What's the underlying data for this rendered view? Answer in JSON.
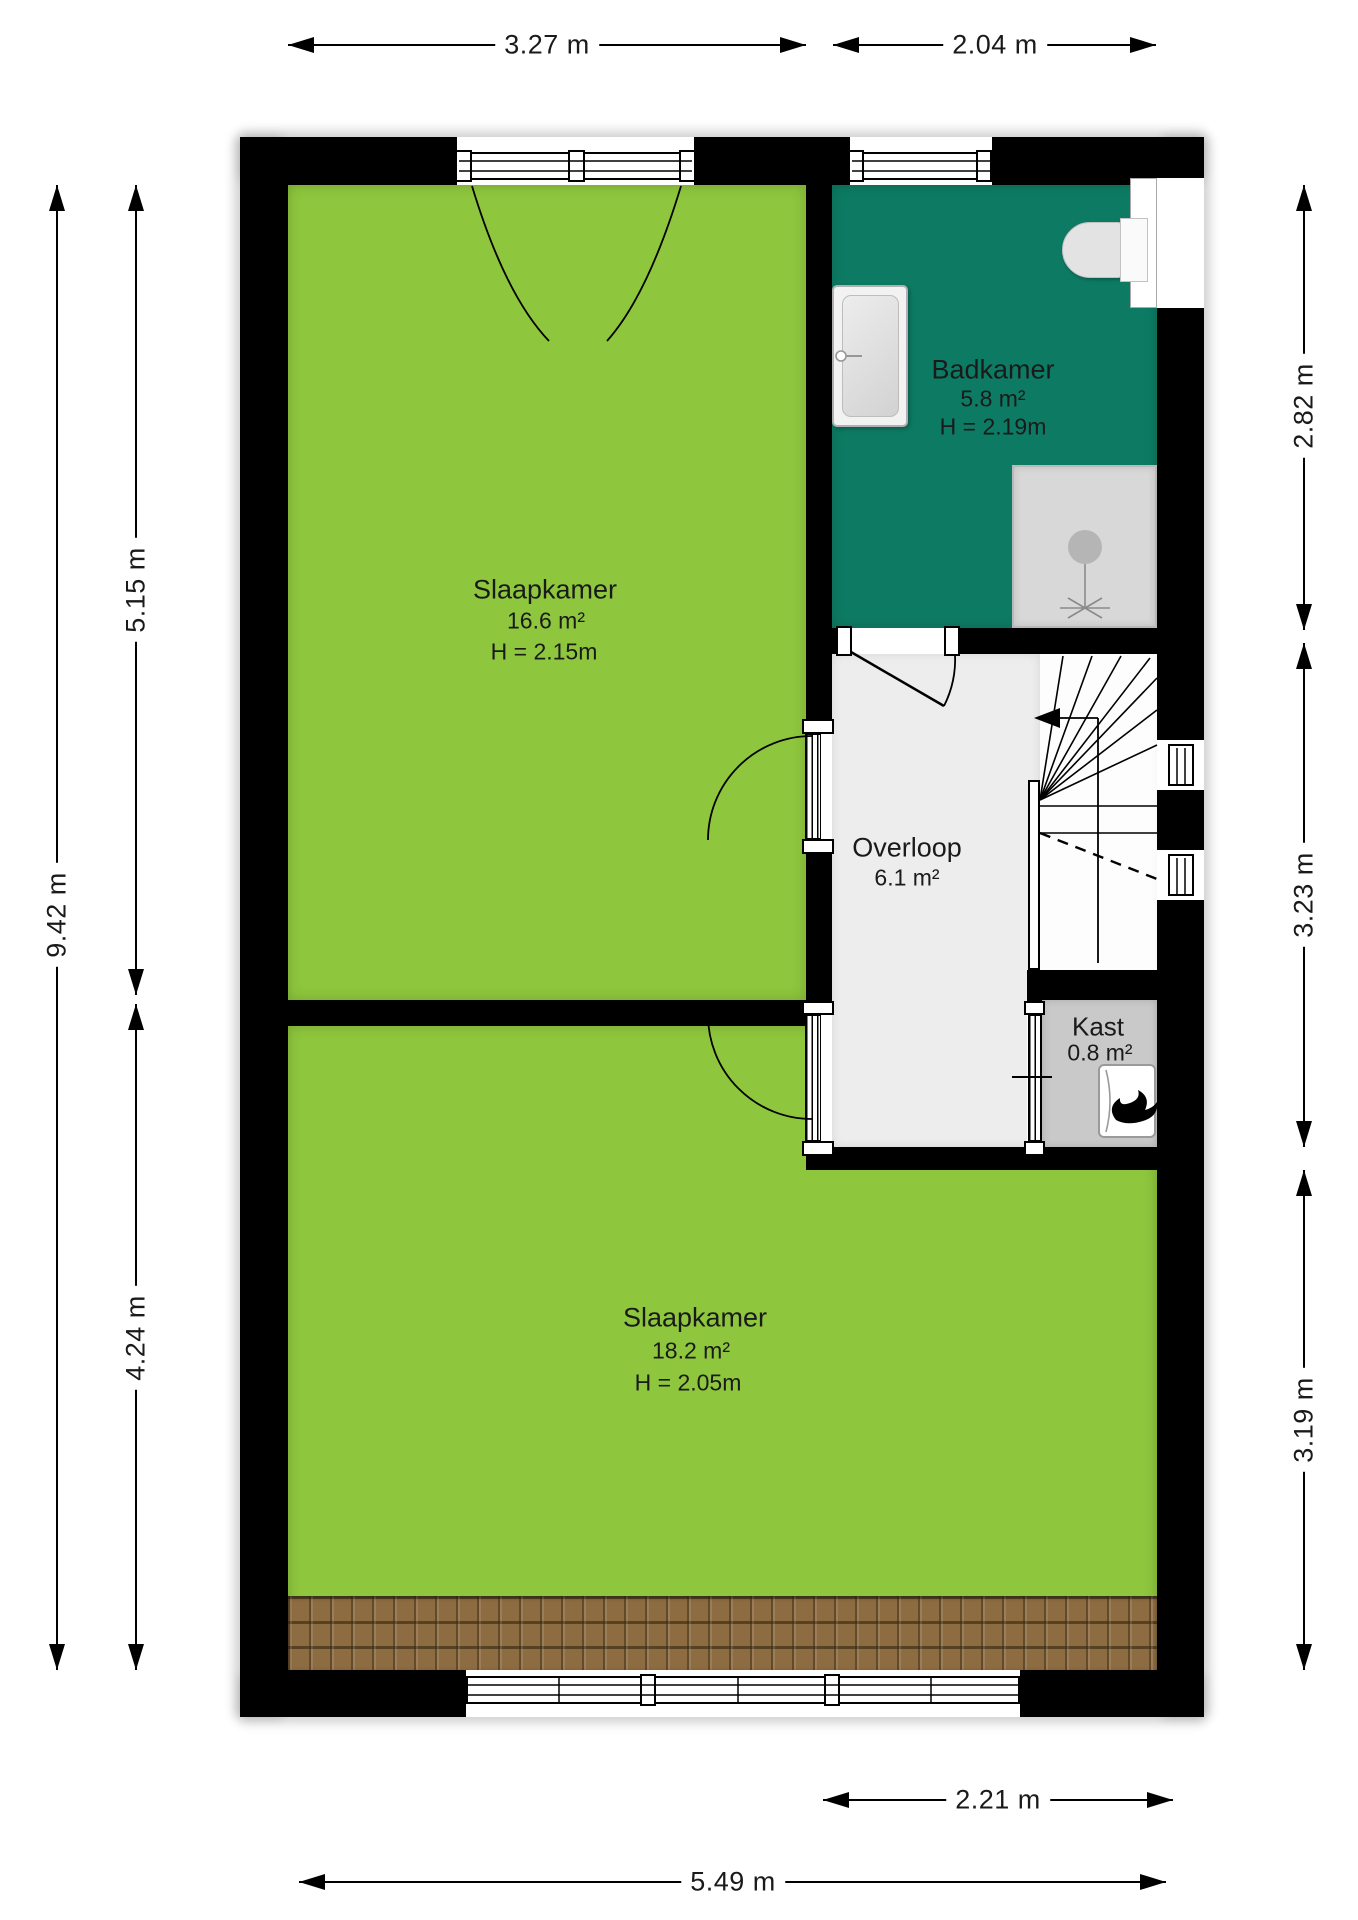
{
  "floorplan": {
    "rooms": {
      "slaapkamer1": {
        "name": "Slaapkamer",
        "area": "16.6 m²",
        "height": "H = 2.15m"
      },
      "badkamer": {
        "name": "Badkamer",
        "area": "5.8 m²",
        "height": "H = 2.19m"
      },
      "overloop": {
        "name": "Overloop",
        "area": "6.1 m²"
      },
      "kast": {
        "name": "Kast",
        "area": "0.8 m²"
      },
      "slaapkamer2": {
        "name": "Slaapkamer",
        "area": "18.2 m²",
        "height": "H = 2.05m"
      }
    },
    "dimensions": {
      "top_left": "3.27 m",
      "top_right": "2.04 m",
      "left_outer": "9.42 m",
      "left_upper": "5.15 m",
      "left_lower": "4.24 m",
      "right_upper": "2.82 m",
      "right_middle": "3.23 m",
      "right_lower": "3.19 m",
      "bottom_inner": "2.21 m",
      "bottom_outer": "5.49 m"
    },
    "icons": {
      "flame": "boiler-flame-icon",
      "arrow": "stairs-direction-arrow"
    },
    "colors": {
      "bedroom_green": "#8ec63d",
      "bathroom_teal": "#0d7b63",
      "landing_gray": "#ededed",
      "closet_gray": "#c9c9c9",
      "shower_gray": "#d8d8d8",
      "wall_black": "#000000",
      "roof_brown": "#8d6c42"
    }
  }
}
